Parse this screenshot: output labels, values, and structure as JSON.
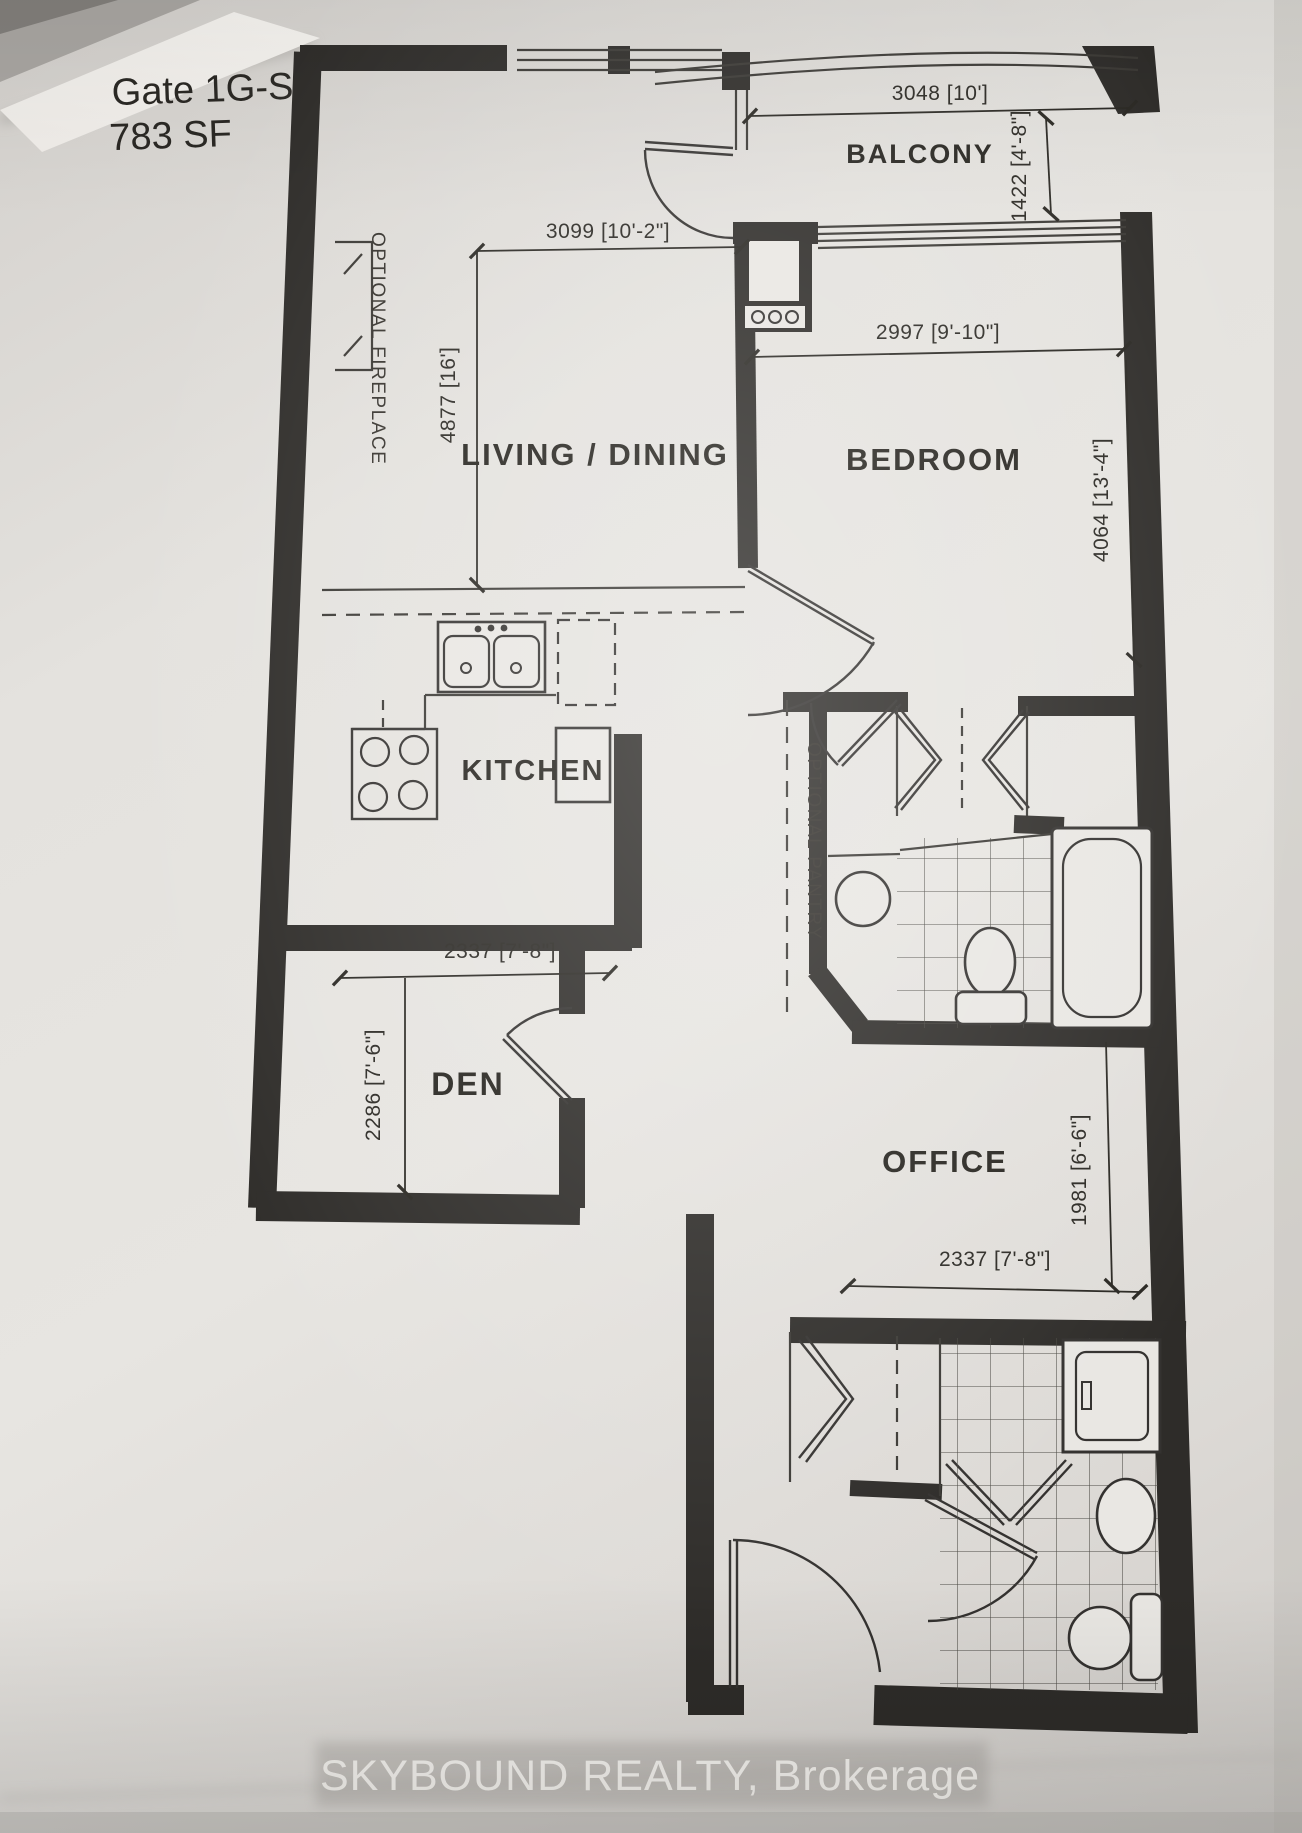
{
  "plan": {
    "title": {
      "line1": "Gate 1G-S",
      "line2": "783 SF"
    },
    "rooms": {
      "balcony": {
        "label": "BALCONY",
        "width": "3048 [10']",
        "depth": "1422 [4'-8\"]"
      },
      "living_dining": {
        "label": "LIVING / DINING",
        "width": "3099 [10'-2\"]",
        "depth": "4877 [16']"
      },
      "bedroom": {
        "label": "BEDROOM",
        "width": "2997 [9'-10\"]",
        "depth": "4064 [13'-4\"]"
      },
      "kitchen": {
        "label": "KITCHEN"
      },
      "den": {
        "label": "DEN",
        "width": "2337 [7'-8\"]",
        "depth": "2286 [7'-6\"]"
      },
      "office": {
        "label": "OFFICE",
        "width": "2337 [7'-8\"]",
        "depth": "1981 [6'-6\"]"
      }
    },
    "annotations": {
      "fireplace": "OPTIONAL FIREPLACE",
      "pantry": "OPTIONAL PANTRY"
    },
    "footer": {
      "brokerage": "SKYBOUND REALTY, Brokerage"
    },
    "colors": {
      "ink": "#2e2c29",
      "paper": "#e4e2de",
      "footer_text": "#f6f4f0"
    }
  }
}
